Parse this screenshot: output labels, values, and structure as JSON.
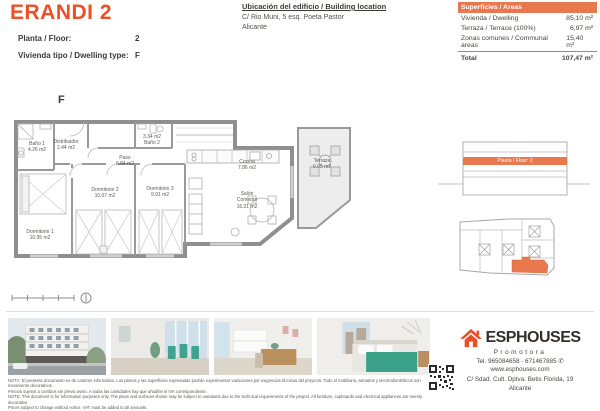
{
  "header": {
    "title": "ERANDI 2",
    "floor_label": "Planta / Floor:",
    "floor_value": "2",
    "type_label": "Vivienda tipo / Dwelling type:",
    "type_value": "F"
  },
  "location": {
    "heading": "Ubicación del edificio / Building location",
    "address_line1": "C/ Rio Muni, 5 esq. Poeta Pastor",
    "address_line2": "Alicante"
  },
  "areas_table": {
    "header": "Superficies / Areas",
    "rows": [
      {
        "label": "Vivienda / Dwelling",
        "value": "85,10 m²"
      },
      {
        "label": "Terraza / Terrace (100%)",
        "value": "6,97 m²"
      },
      {
        "label": "Zonas comunes / Communal areas",
        "value": "15,40 m²"
      }
    ],
    "total_label": "Total",
    "total_value": "107,47 m²"
  },
  "plan": {
    "dwelling_letter": "F",
    "rooms": [
      {
        "id": "bano1",
        "lines": [
          "Baño 1",
          "4.26 m2"
        ]
      },
      {
        "id": "distribuidor",
        "lines": [
          "Distribuidor",
          "2.44 m2"
        ]
      },
      {
        "id": "bano2",
        "lines": [
          "3.34 m2",
          "Baño 2"
        ]
      },
      {
        "id": "paso",
        "lines": [
          "Paso",
          "6.84 m2"
        ]
      },
      {
        "id": "dormitorio2",
        "lines": [
          "Dormitorio 2",
          "10.07 m2"
        ]
      },
      {
        "id": "dormitorio3",
        "lines": [
          "Dormitorio 3",
          "9.91 m2"
        ]
      },
      {
        "id": "dormitorio1",
        "lines": [
          "Dormitorio 1",
          "10.95 m2"
        ]
      },
      {
        "id": "cocina",
        "lines": [
          "Cocina",
          "7.86 m2"
        ]
      },
      {
        "id": "salon",
        "lines": [
          "Salón",
          "Comedor",
          "16.21 m2"
        ]
      },
      {
        "id": "terraza",
        "lines": [
          "Terraza",
          "6.03 m2"
        ]
      }
    ]
  },
  "elevation": {
    "band_label": "Planta / Floor: 2"
  },
  "photos": [
    {
      "name": "building exterior"
    },
    {
      "name": "living dining room"
    },
    {
      "name": "kitchen living area"
    },
    {
      "name": "bedroom"
    }
  ],
  "footer": {
    "disclaimer_es_1": "NOTA: El presente documento es de carácter informativo. Los planos y las superficies expresadas podrán experimentar variaciones por exigencias técnicas del proyecto. Todo el mobiliario, armarios y electrodomésticos son meramente decorativos.",
    "disclaimer_es_2": "Precios sujetos a cambios sin previo aviso. A todas las cantidades hay que añadirle el IVA correspondiente.",
    "disclaimer_en_1": "NOTE: This document is for information purposes only. The plans and surfaces shown may be subject to variations due to the technical requirements of the project. All furniture, cupboards and electrical appliances are merely decorative.",
    "disclaimer_en_2": "Prices subject to change without notice. VAT must be added to all amounts."
  },
  "brand": {
    "name": "ESPHOUSES",
    "tagline": "Promotora",
    "phone": "Tel. 965084658 - 671467885",
    "website": "www.esphouses.com",
    "address": "C/ Sdad. Cult. Dptva. Betis Florida, 19",
    "city": "Alicante"
  },
  "colors": {
    "accent": "#ee4f26",
    "table_orange": "#e8784e",
    "highlight": "#e8794e"
  }
}
